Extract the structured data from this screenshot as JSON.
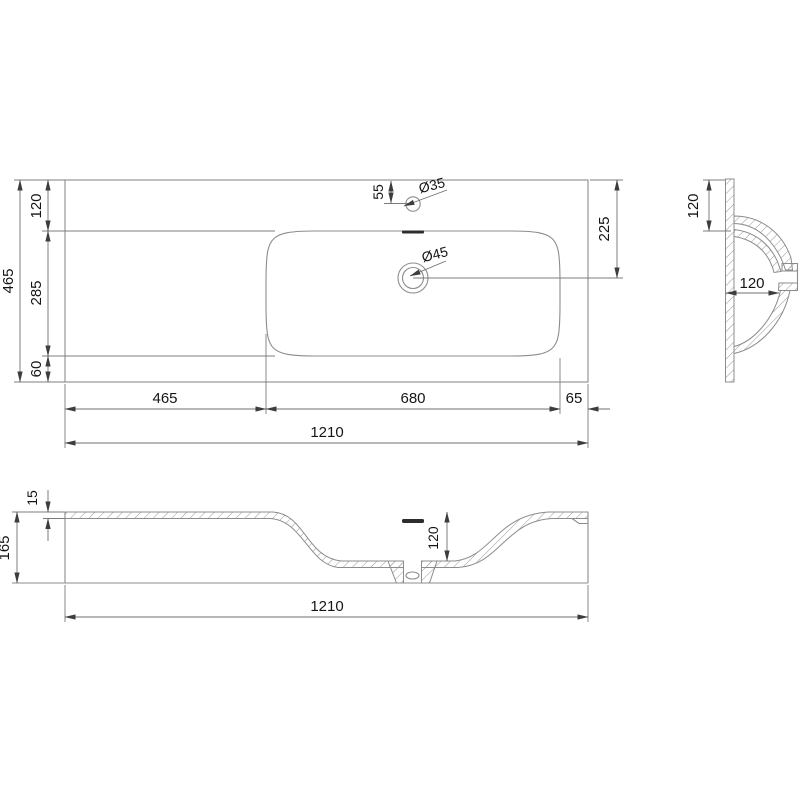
{
  "drawing": {
    "description": "washbasin technical drawing, three orthographic views",
    "colors": {
      "line": "#8c8c8c",
      "dimension": "#6f6f6f",
      "text": "#151515",
      "background": "#ffffff"
    },
    "top_view": {
      "overall_depth": "465",
      "back_margin": "120",
      "basin_depth": "285",
      "front_margin": "60",
      "faucet_offset": "55",
      "faucet_hole_dia": "Ø35",
      "drain_hole_dia": "Ø45",
      "drain_center_from_back": "225",
      "left_counter_width": "465",
      "basin_width": "680",
      "right_margin": "65",
      "overall_width": "1210"
    },
    "side_view": {
      "back_margin": "120",
      "bowl_inner_width": "120"
    },
    "front_section": {
      "deck_thickness": "15",
      "overall_height": "165",
      "bowl_depth": "120",
      "overall_width": "1210"
    }
  }
}
